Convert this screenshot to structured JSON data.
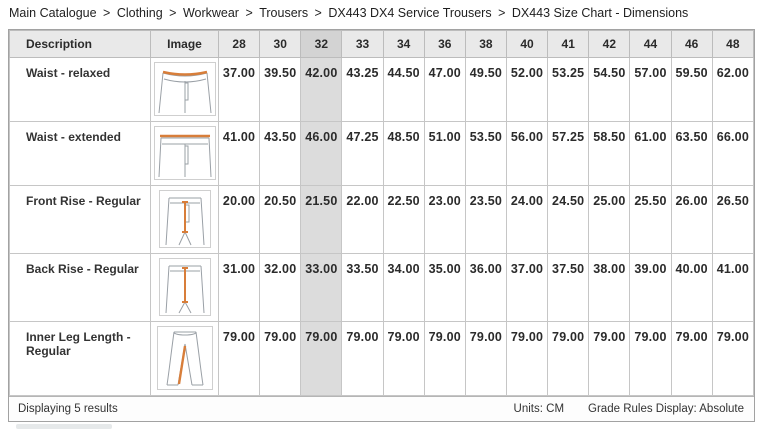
{
  "breadcrumb": {
    "items": [
      "Main Catalogue",
      "Clothing",
      "Workwear",
      "Trousers",
      "DX443 DX4 Service Trousers",
      "DX443 Size Chart - Dimensions"
    ],
    "separator": ">"
  },
  "table": {
    "description_header": "Description",
    "image_header": "Image",
    "size_headers": [
      "28",
      "30",
      "32",
      "33",
      "34",
      "36",
      "38",
      "40",
      "41",
      "42",
      "44",
      "46",
      "48"
    ],
    "highlighted_size": "32",
    "rows": [
      {
        "description": "Waist - relaxed",
        "image": "trousers-waist-relaxed",
        "values": [
          "37.00",
          "39.50",
          "42.00",
          "43.25",
          "44.50",
          "47.00",
          "49.50",
          "52.00",
          "53.25",
          "54.50",
          "57.00",
          "59.50",
          "62.00"
        ]
      },
      {
        "description": "Waist - extended",
        "image": "trousers-waist-extended",
        "values": [
          "41.00",
          "43.50",
          "46.00",
          "47.25",
          "48.50",
          "51.00",
          "53.50",
          "56.00",
          "57.25",
          "58.50",
          "61.00",
          "63.50",
          "66.00"
        ]
      },
      {
        "description": "Front Rise - Regular",
        "image": "trousers-front-rise",
        "values": [
          "20.00",
          "20.50",
          "21.50",
          "22.00",
          "22.50",
          "23.00",
          "23.50",
          "24.00",
          "24.50",
          "25.00",
          "25.50",
          "26.00",
          "26.50"
        ]
      },
      {
        "description": "Back Rise - Regular",
        "image": "trousers-back-rise",
        "values": [
          "31.00",
          "32.00",
          "33.00",
          "33.50",
          "34.00",
          "35.00",
          "36.00",
          "37.00",
          "37.50",
          "38.00",
          "39.00",
          "40.00",
          "41.00"
        ]
      },
      {
        "description": "Inner Leg Length - Regular",
        "image": "trousers-inner-leg",
        "values": [
          "79.00",
          "79.00",
          "79.00",
          "79.00",
          "79.00",
          "79.00",
          "79.00",
          "79.00",
          "79.00",
          "79.00",
          "79.00",
          "79.00",
          "79.00"
        ]
      }
    ]
  },
  "footer": {
    "results_text": "Displaying 5 results",
    "units_label": "Units: CM",
    "grade_rules_label": "Grade Rules Display: Absolute"
  },
  "colors": {
    "accent_orange": "#d87e3a",
    "header_bg": "#e9e9e9",
    "highlight_header_bg": "#d3d3d3",
    "highlight_cell_bg": "#dcdcdc",
    "outline_gray": "#9aa0a6"
  }
}
